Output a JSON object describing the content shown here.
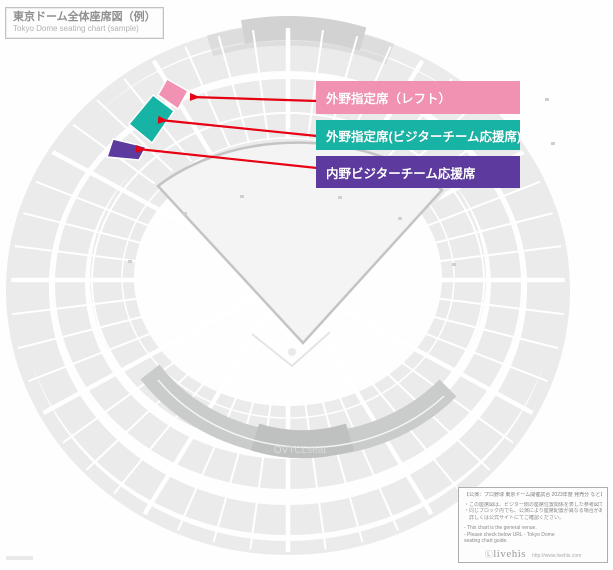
{
  "title": {
    "ja": "東京ドーム全体座席図（例）",
    "en": "Tokyo Dome seating chart (sample)"
  },
  "legend": {
    "arrow_color": "#e60012",
    "items": [
      {
        "label": "外野指定席（レフト）",
        "color": "#f292b2"
      },
      {
        "label": "外野指定席(ビジターチーム応援席)",
        "color": "#17b3a4"
      },
      {
        "label": "内野ビジターチーム応援席",
        "color": "#5c3a9e"
      }
    ]
  },
  "stadium": {
    "colors": {
      "block": "#ebebeb",
      "rim": "#d2d2d2",
      "crescent": "#c9cccb",
      "crescent_dark": "#bfc1c0",
      "field": "#f4f4f5",
      "boundary": "#c4c4c4"
    },
    "watermark": "OVTCLseat"
  },
  "info_box": {
    "header": "【公演：プロ野球 東京ドーム開催試合 2023年度 発売分 など】",
    "notes_ja": [
      "・この座席図は、ビジター側の座席位置関係を表した参考図です。",
      "・同じブロック内でも、公演により座席配置が異なる場合があります。",
      "　詳しくは公式サイトにてご確認ください。"
    ],
    "notes_en": [
      "- This chart is the general venue.",
      "- Please check below URL - Tokyo Dome",
      "  seating chart guide."
    ],
    "logo_mark": "Ⓛ",
    "logo": "livehis",
    "url": "http://www.livehis.com"
  }
}
